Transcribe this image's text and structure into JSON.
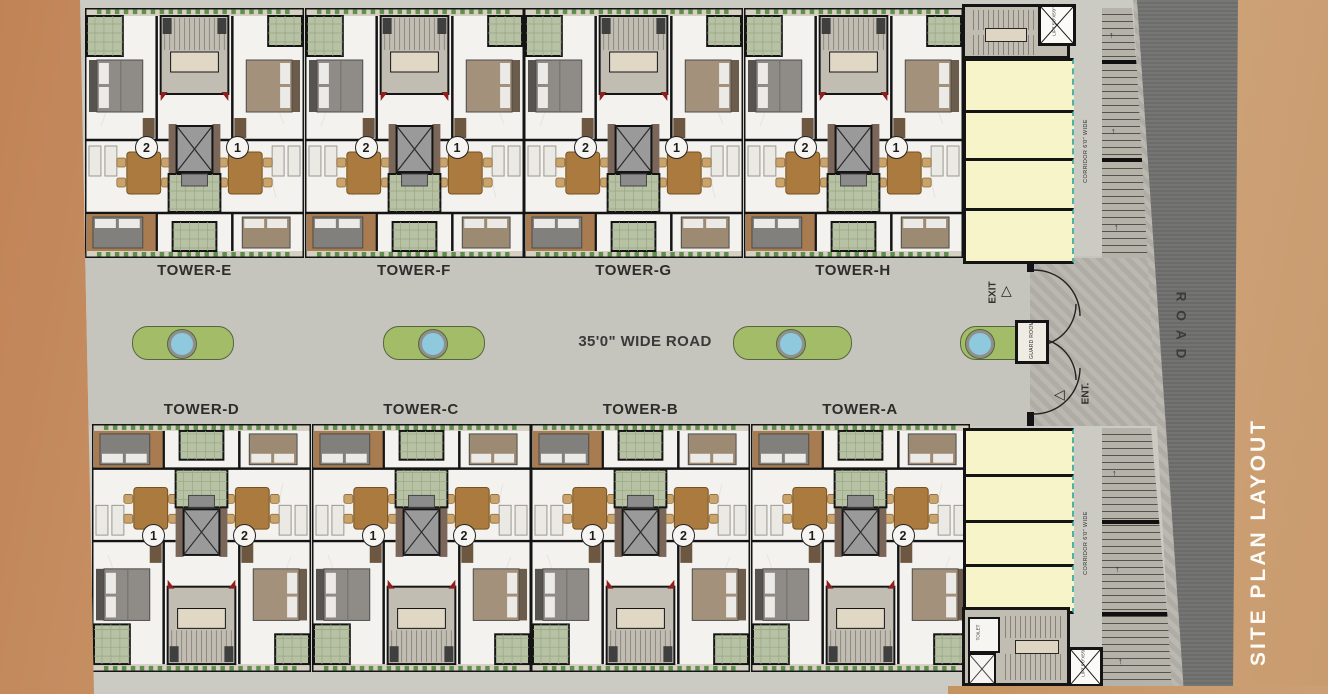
{
  "page_title": "SITE PLAN LAYOUT",
  "road_vertical_label": "ROAD",
  "central_road_label": "35'0\" WIDE ROAD",
  "towers_top": [
    {
      "label": "TOWER-E",
      "unit_left": "2",
      "unit_right": "1"
    },
    {
      "label": "TOWER-F",
      "unit_left": "2",
      "unit_right": "1"
    },
    {
      "label": "TOWER-G",
      "unit_left": "2",
      "unit_right": "1"
    },
    {
      "label": "TOWER-H",
      "unit_left": "2",
      "unit_right": "1"
    }
  ],
  "towers_bottom": [
    {
      "label": "TOWER-D",
      "unit_left": "1",
      "unit_right": "2"
    },
    {
      "label": "TOWER-C",
      "unit_left": "1",
      "unit_right": "2"
    },
    {
      "label": "TOWER-B",
      "unit_left": "1",
      "unit_right": "2"
    },
    {
      "label": "TOWER-A",
      "unit_left": "1",
      "unit_right": "2"
    }
  ],
  "gate": {
    "exit_label": "EXIT",
    "entry_label": "ENT.",
    "guard_room_label": "GUARD ROOM"
  },
  "services": {
    "corridor_label": "CORRIDOR 6'0\" WIDE",
    "lift_label": "LIFT 5'0\"X5'0\"",
    "toilet_label": "TOILET",
    "shop_count_top": 4,
    "shop_count_bottom": 4
  },
  "colors": {
    "background_tan": "#c99a6d",
    "road_dark": "#6e6e6e",
    "pavement_gray": "#c5c4bd",
    "island_green": "#a3bc68",
    "pool_blue": "#8ec9de",
    "shop_yellow": "#f8f4c9",
    "shopfront_teal": "#4fb0a5",
    "title_white": "#fcfbf8"
  }
}
